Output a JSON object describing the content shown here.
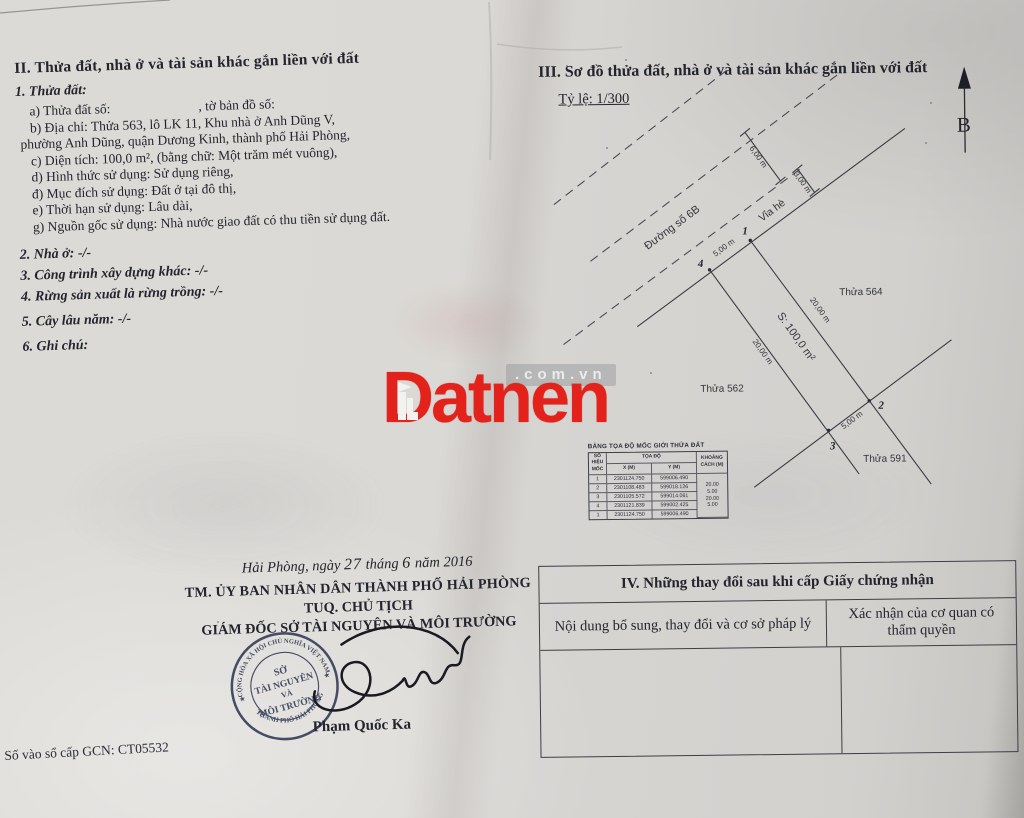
{
  "page": {
    "left": {
      "section2_title": "II. Thửa đất, nhà ở và tài sản khác gắn liền với đất",
      "item1_title": "1. Thửa đất:",
      "a_label": "a) Thửa đất số:",
      "a_label2": ", tờ bản đồ số:",
      "b_line1": "b) Địa chỉ: Thửa 563, lô LK 11, Khu nhà ở Anh Dũng V,",
      "b_line2": "phường Anh Dũng, quận Dương Kinh, thành phố Hải Phòng,",
      "c_line": "c) Diện tích: 100,0 m², (bằng chữ: Một trăm mét vuông),",
      "d_line": "d) Hình thức sử dụng: Sử dụng riêng,",
      "dd_line": "đ) Mục đích sử dụng: Đất ở tại đô thị,",
      "e_line": "e) Thời hạn sử dụng: Lâu dài,",
      "g_line": "g) Nguồn gốc sử dụng: Nhà nước giao đất có thu tiền sử dụng đất.",
      "item2": "2. Nhà ở: -/-",
      "item3": "3. Công trình xây dựng khác: -/-",
      "item4": "4. Rừng sản xuất là rừng trồng: -/-",
      "item5": "5. Cây lâu năm: -/-",
      "item6": "6. Ghi chú:",
      "date_prefix": "Hải Phòng, ngày",
      "date_day": "27",
      "date_mid": "tháng",
      "date_month": "6",
      "date_suffix": "năm 2016",
      "sig_org": "TM. ỦY BAN NHÂN DÂN THÀNH PHỐ HẢI PHÒNG",
      "sig_role": "TUQ. CHỦ TỊCH",
      "sig_title": "GIÁM ĐỐC SỞ TÀI NGUYÊN VÀ MÔI TRƯỜNG",
      "signer_name": "Phạm Quốc Ka",
      "book_number": "Số vào sổ cấp GCN: CT05532",
      "stamp": {
        "arc_top": "CỘNG HÒA XÃ HỘI CHỦ NGHĨA VIỆT NAM",
        "arc_bottom": "THÀNH PHỐ HẢI PHÒNG",
        "center_l1": "SỞ",
        "center_l2": "TÀI NGUYÊN",
        "center_l3": "VÀ",
        "center_l4": "MÔI TRƯỜNG",
        "star_left": "★",
        "star_right": "★"
      }
    },
    "right": {
      "section3_title": "III. Sơ đồ thửa đất, nhà ở và tài sản khác gắn liền với đất",
      "scale_label": "Tỷ lệ: 1/300",
      "north_label": "B",
      "diagram": {
        "road_label": "Đường số 6B",
        "sidewalk_label": "Vỉa hè",
        "parcel_area": "S: 100,0 m²",
        "dim_road_width": "6,00 m",
        "dim_sidewalk_width": "3,00 m",
        "dim_front": "5,00 m",
        "dim_back": "5,00 m",
        "dim_right": "20,00 m",
        "dim_left": "20,00 m",
        "neighbor_right": "Thửa 564",
        "neighbor_left": "Thửa 562",
        "neighbor_bottom": "Thửa 591",
        "pt1": "1",
        "pt2": "2",
        "pt3": "3",
        "pt4": "4"
      },
      "coord_table": {
        "title": "BẢNG TỌA ĐỘ MỐC GIỚI THỬA ĐẤT",
        "col_corner": "SỐ HIỆU MỐC",
        "col_coords": "TỌA ĐỘ",
        "col_x": "X (M)",
        "col_y": "Y (M)",
        "col_dist": "KHOẢNG CÁCH (M)",
        "rows": [
          {
            "id": "1",
            "x": "2301124.750",
            "y": "599006.490"
          },
          {
            "id": "2",
            "x": "2301108.483",
            "y": "599018.126"
          },
          {
            "id": "3",
            "x": "2301105.572",
            "y": "599014.061"
          },
          {
            "id": "4",
            "x": "2301121.839",
            "y": "599002.425"
          },
          {
            "id": "1",
            "x": "2301124.750",
            "y": "599006.490"
          }
        ],
        "distances": [
          "20.00",
          "5.00",
          "20.00",
          "5.00"
        ]
      },
      "section4_title": "IV. Những thay đổi sau khi cấp Giấy chứng nhận",
      "section4_col1": "Nội dung bổ sung, thay đổi và cơ sở pháp lý",
      "section4_col2": "Xác nhận của cơ quan có thẩm quyền"
    },
    "watermark": {
      "brand": "Datnen",
      "domain": ".com.vn"
    }
  }
}
